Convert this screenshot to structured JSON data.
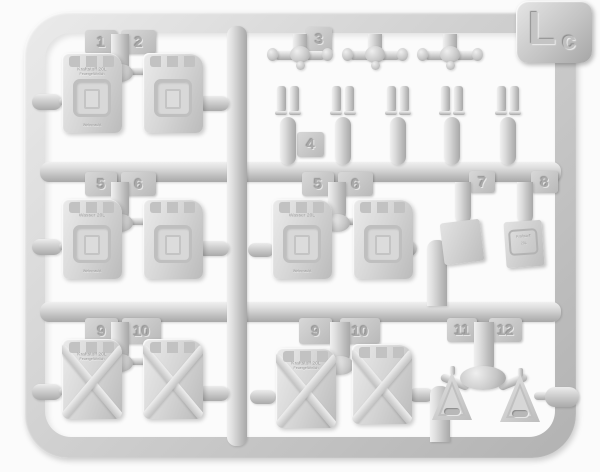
{
  "sprue": {
    "code_main": "L",
    "code_sub": "c",
    "description": "Light gray injection-molded plastic model-kit sprue with twelve numbered part groups: jerry cans, filler-cap assemblies, lid clamps, flat panels and triangular brackets",
    "plastic_color": "#cdcdcd",
    "background_color": "#fbfbfb"
  },
  "part_numbers": {
    "n1": "1",
    "n2": "2",
    "n3": "3",
    "n4": "4",
    "n5": "5",
    "n6": "6",
    "n7": "7",
    "n8": "8",
    "n9": "9",
    "n10": "10",
    "n11": "11",
    "n12": "12"
  },
  "embossed_text": {
    "fuel_line1": "Kraftstoff 20L",
    "fuel_line2": "Feuergefährlich",
    "wehrmacht": "Wehrmacht",
    "water_line1": "Wasser 20L",
    "plate_line1": "Kraftstoff",
    "plate_line2": "20L"
  },
  "parts_inventory": [
    {
      "number": "1",
      "type": "jerry can with embossed fuel markings",
      "qty": 1
    },
    {
      "number": "2",
      "type": "jerry can, plain",
      "qty": 1
    },
    {
      "number": "3",
      "type": "filler cap / spout assembly",
      "qty": 3
    },
    {
      "number": "4",
      "type": "lid clamp pair",
      "qty": 5
    },
    {
      "number": "5",
      "type": "jerry can with embossed water markings",
      "qty": 2
    },
    {
      "number": "6",
      "type": "jerry can, plain",
      "qty": 2
    },
    {
      "number": "7",
      "type": "flat panel",
      "qty": 1
    },
    {
      "number": "8",
      "type": "flat panel with embossed plate",
      "qty": 1
    },
    {
      "number": "9",
      "type": "X-ribbed jerry can with embossed markings",
      "qty": 2
    },
    {
      "number": "10",
      "type": "X-ribbed jerry can, plain",
      "qty": 2
    },
    {
      "number": "11",
      "type": "triangular bracket",
      "qty": 1
    },
    {
      "number": "12",
      "type": "triangular bracket",
      "qty": 1
    }
  ]
}
